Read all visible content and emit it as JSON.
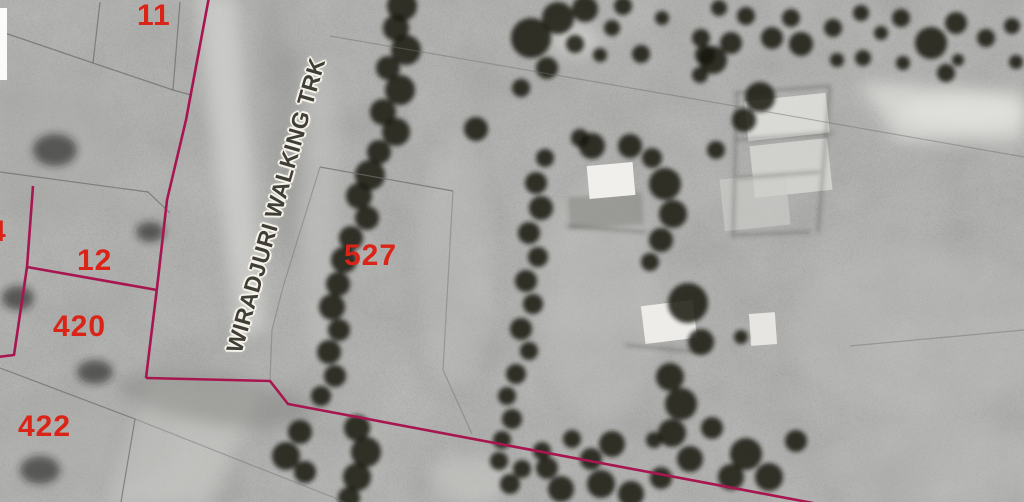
{
  "map": {
    "description": "Black and white aerial photograph with cadastral parcel overlay",
    "parcel_labels": [
      {
        "text": "11",
        "x": 137,
        "y": 1
      },
      {
        "text": "4",
        "x": -11,
        "y": 217
      },
      {
        "text": "12",
        "x": 77,
        "y": 246
      },
      {
        "text": "420",
        "x": 53,
        "y": 312
      },
      {
        "text": "422",
        "x": 18,
        "y": 412
      },
      {
        "text": "527",
        "x": 344,
        "y": 241
      }
    ],
    "road_label": {
      "text": "WIRADJURI WALKING TRK",
      "rotation_deg": -74
    },
    "colors": {
      "cadastral_boundary": "#a8164f",
      "parcel_line": "#6e6e6e",
      "parcel_label": "#da2418",
      "road_text": "#403f37",
      "road_halo": "#f5f3e9"
    }
  }
}
